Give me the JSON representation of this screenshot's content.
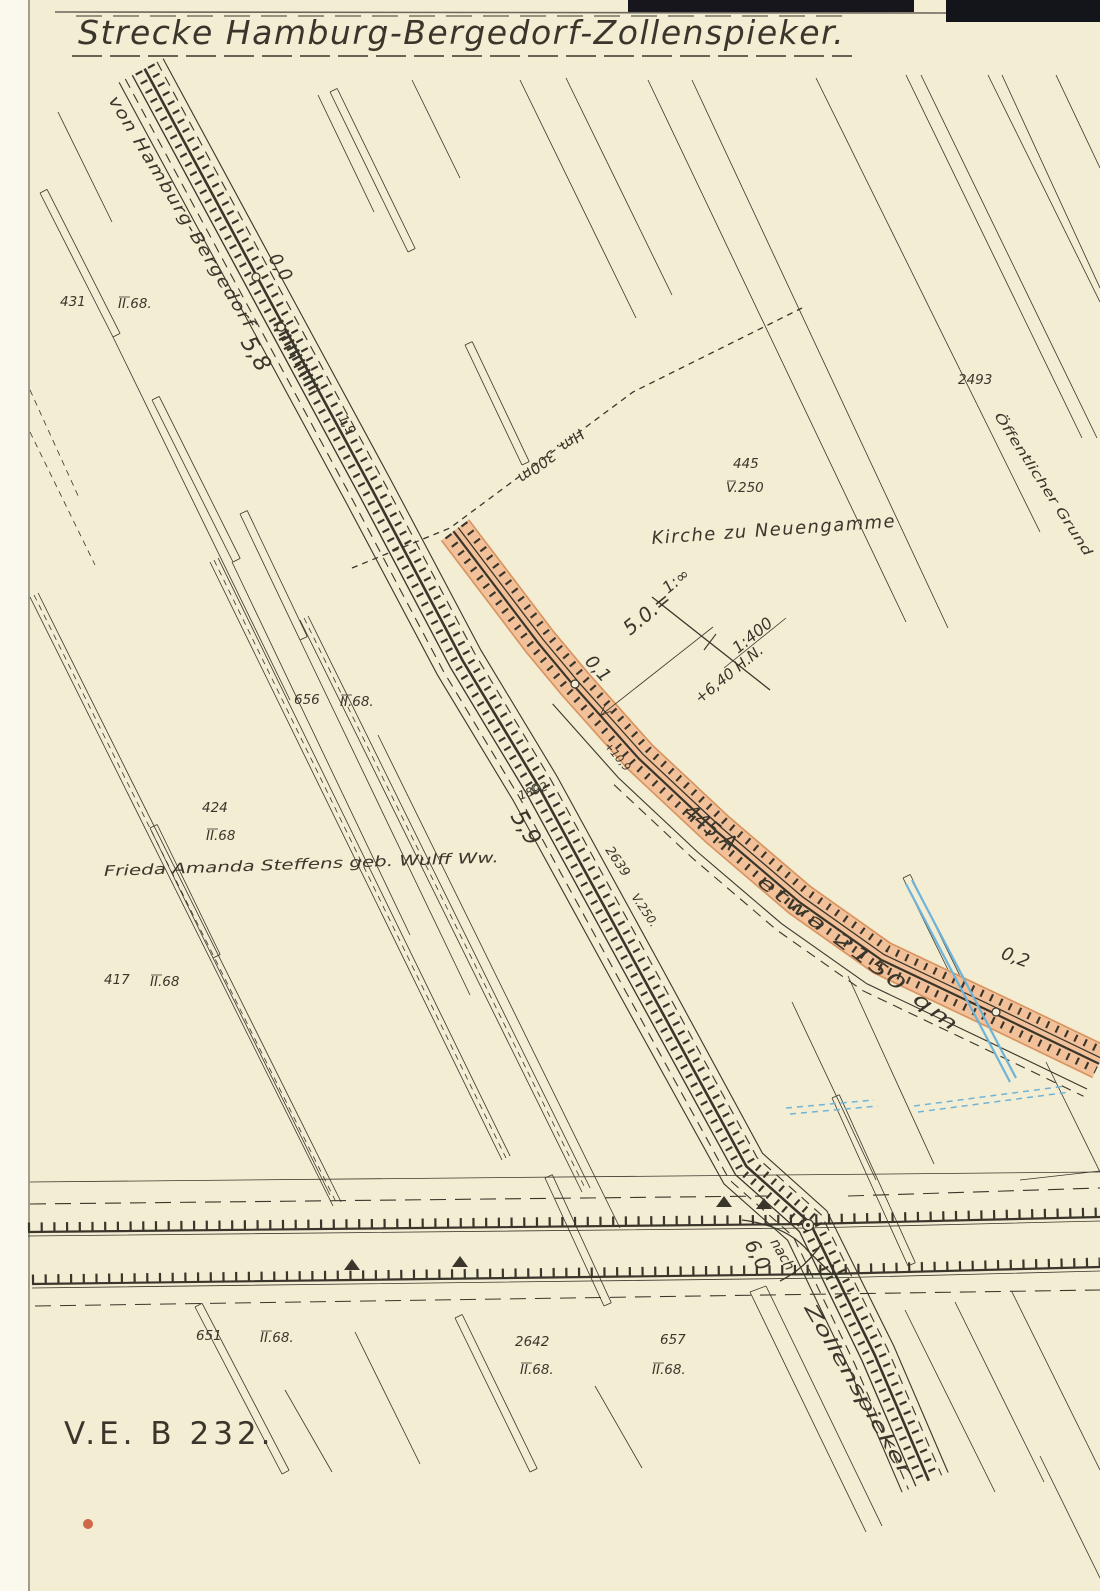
{
  "document": {
    "title": "Strecke Hamburg-Bergedorf-Zollenspieker.",
    "sheet_number": "V.E. B 232."
  },
  "railway": {
    "origin_label": "von Hamburg-Bergedorf",
    "branch_prefix": "nach",
    "branch_destination": "Zollenspieker",
    "km": {
      "k00": "0,0",
      "k58": "5,8",
      "k19": "1,9",
      "k01": "0,1",
      "k59": "5,9",
      "k02": "0,2",
      "k60": "6,0"
    },
    "hectometer_note": "Hm. 300m",
    "year_mark": "1892",
    "level_mark": "+10,9"
  },
  "gradient_note": {
    "left": "1:∞",
    "right": "1:400",
    "length": "5.0.=",
    "height": "+6,40 H.N."
  },
  "area_note": {
    "parcel": "445 A",
    "area": "etwa 2150 qm"
  },
  "notes": {
    "church": "Kirche zu Neuengamme",
    "owner": "Frieda Amanda Steffens geb. Wulff Ww.",
    "public_ground": "Öffentlicher Grund"
  },
  "parcels": [
    {
      "number": "431",
      "class": "II.68."
    },
    {
      "number": "2493",
      "class": ""
    },
    {
      "number": "445",
      "class": "V.250"
    },
    {
      "number": "656",
      "class": "II.68."
    },
    {
      "number": "424",
      "class": "II.68"
    },
    {
      "number": "2639",
      "class": "V.250."
    },
    {
      "number": "417",
      "class": "II.68"
    },
    {
      "number": "651",
      "class": "II.68."
    },
    {
      "number": "2642",
      "class": "II.68."
    },
    {
      "number": "657",
      "class": "II.68."
    }
  ],
  "colors": {
    "paper": "#f2edd3",
    "margin": "#fbf9ee",
    "ink": "#3a362b",
    "highlight": "#f2bd94",
    "highlight_edge": "#d6935f",
    "water_blue": "#6fb4d8",
    "stamp_red": "#c8502f",
    "top_band": "#16161c"
  }
}
